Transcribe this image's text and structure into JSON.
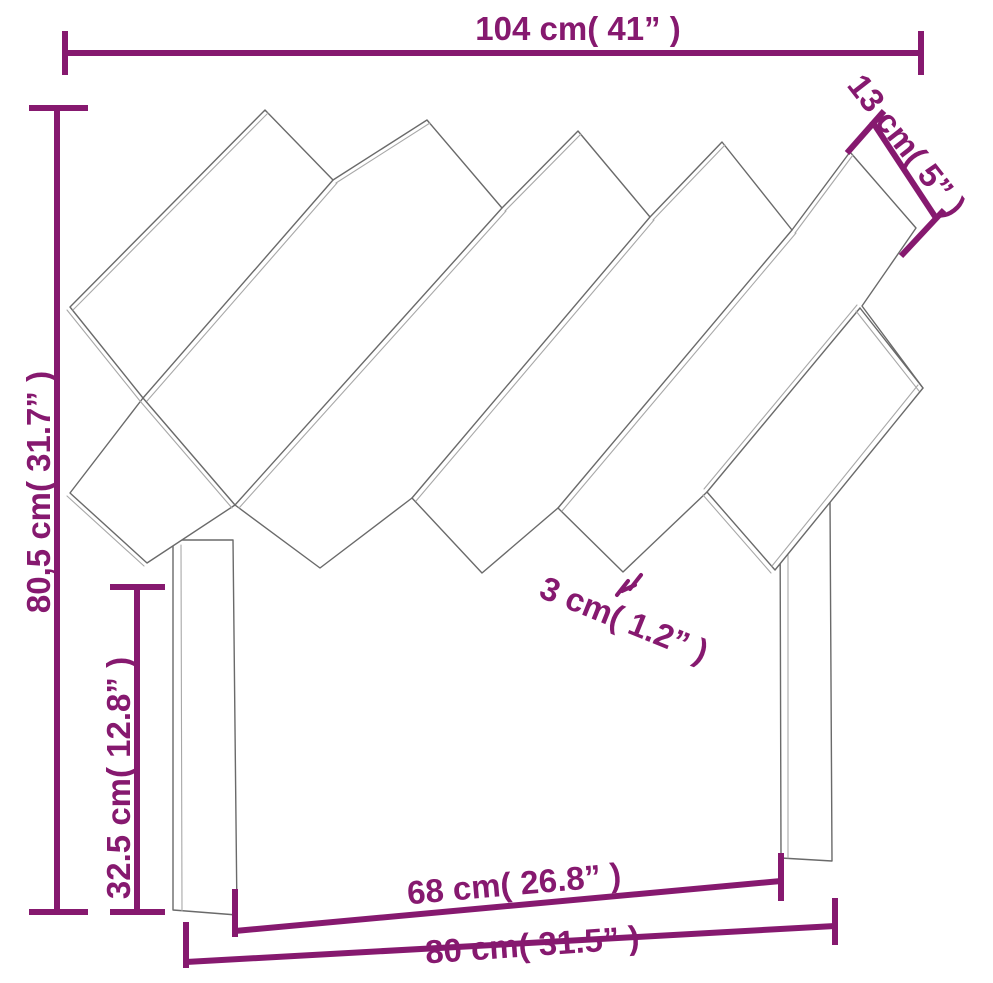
{
  "diagram": {
    "title": "Headboard dimension drawing",
    "colors": {
      "dimension_accent": "#86196f",
      "sketch_outline": "#6a6a6a",
      "sketch_outline_light": "#a8a8a8",
      "background": "#ffffff"
    },
    "dimensions": {
      "top_width": {
        "cm": "104",
        "inches": "41",
        "label": "104 cm( 41” )"
      },
      "slat_width": {
        "cm": "13",
        "inches": "5",
        "label": "13 cm( 5” )"
      },
      "total_height": {
        "cm": "80,5",
        "inches": "31.7",
        "label": "80,5 cm( 31.7” )"
      },
      "leg_height": {
        "cm": "32.5",
        "inches": "12.8",
        "label": "32.5 cm( 12.8” )"
      },
      "slat_thickness": {
        "cm": "3",
        "inches": "1.2",
        "label": "3 cm( 1.2” )"
      },
      "inner_width": {
        "cm": "68",
        "inches": "26.8",
        "label": "68 cm( 26.8” )"
      },
      "base_width": {
        "cm": "80",
        "inches": "31.5",
        "label": "80 cm( 31.5” )"
      }
    }
  }
}
